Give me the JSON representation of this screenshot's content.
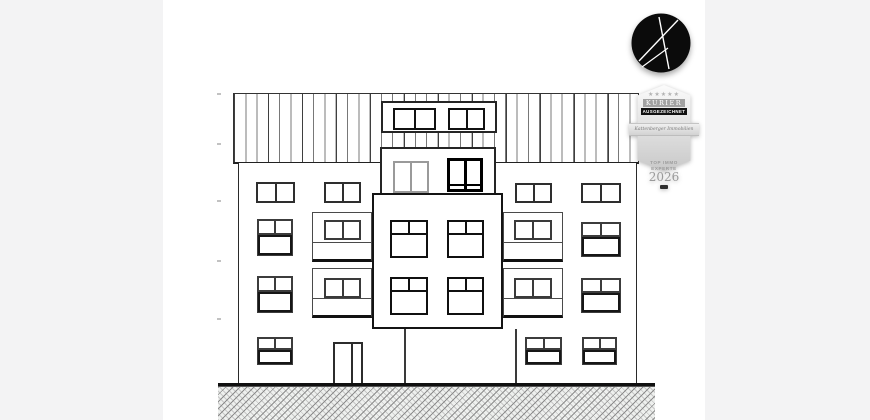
{
  "page": {
    "bg_color": "#f3f3f4",
    "canvas_bg": "#ffffff"
  },
  "branding": {
    "logo": {
      "shape": "black-circle-with-stylized-white-K",
      "bg": "#0b0b0b",
      "stroke": "#ffffff"
    },
    "badge": {
      "stars_text": "★★★★★",
      "masthead": "KURIER",
      "award": "AUSGEZEICHNET",
      "ribbon": "Kattenberger Immobilien",
      "category_line1": "TOP IMMO",
      "category_line2": "EXPERTE",
      "year": "2026"
    }
  },
  "drawing": {
    "kind": "building front elevation, line drawing",
    "line_color": "#2a2a2a",
    "roof": {
      "x": 233,
      "y": 93,
      "w": 406,
      "h": 71
    },
    "facade": {
      "x": 238,
      "y": 163,
      "w": 399,
      "h": 221
    },
    "dormer": {
      "x": 381,
      "y": 101,
      "w": 116,
      "h": 32
    },
    "penthouse": {
      "x": 380,
      "y": 147,
      "w": 116,
      "h": 48
    },
    "bay": {
      "x": 372,
      "y": 193,
      "w": 131,
      "h": 136
    },
    "bay_base_walls": [
      {
        "x": 404,
        "y": 329,
        "h": 55
      },
      {
        "x": 515,
        "y": 329,
        "h": 55
      }
    ],
    "door": {
      "x": 333,
      "y": 342,
      "w": 30,
      "h": 42
    },
    "ground_line": {
      "x": 218,
      "y": 383,
      "w": 437,
      "h": 2.5
    },
    "ground_hatch": {
      "x": 218,
      "y": 385.5,
      "w": 437,
      "h": 34.5
    },
    "level_ticks": [
      {
        "x": 217,
        "y": 93
      },
      {
        "x": 217,
        "y": 143
      },
      {
        "x": 217,
        "y": 200
      },
      {
        "x": 217,
        "y": 260
      },
      {
        "x": 217,
        "y": 318
      }
    ],
    "balconies": [
      {
        "x": 312,
        "y": 212,
        "w": 60,
        "h": 50,
        "railing_h": 20
      },
      {
        "x": 503,
        "y": 212,
        "w": 60,
        "h": 50,
        "railing_h": 20
      },
      {
        "x": 312,
        "y": 268,
        "w": 60,
        "h": 50,
        "railing_h": 20
      },
      {
        "x": 503,
        "y": 268,
        "w": 60,
        "h": 50,
        "railing_h": 20
      }
    ],
    "windows": [
      {
        "x": 393,
        "y": 108,
        "w": 43,
        "h": 22,
        "style": "bold2"
      },
      {
        "x": 448,
        "y": 108,
        "w": 37,
        "h": 22,
        "style": "bold2"
      },
      {
        "x": 393,
        "y": 161,
        "w": 36,
        "h": 32,
        "style": "light2"
      },
      {
        "x": 447,
        "y": 158,
        "w": 36,
        "h": 34,
        "style": "heavy2"
      },
      {
        "x": 256,
        "y": 182,
        "w": 39,
        "h": 21,
        "style": "pane2"
      },
      {
        "x": 324,
        "y": 182,
        "w": 37,
        "h": 21,
        "style": "pane2"
      },
      {
        "x": 515,
        "y": 183,
        "w": 37,
        "h": 20,
        "style": "pane2"
      },
      {
        "x": 581,
        "y": 183,
        "w": 40,
        "h": 20,
        "style": "pane2"
      },
      {
        "x": 257,
        "y": 219,
        "w": 36,
        "h": 37,
        "style": "tee"
      },
      {
        "x": 581,
        "y": 222,
        "w": 40,
        "h": 35,
        "style": "tee"
      },
      {
        "x": 257,
        "y": 276,
        "w": 36,
        "h": 37,
        "style": "tee"
      },
      {
        "x": 581,
        "y": 278,
        "w": 40,
        "h": 35,
        "style": "tee"
      },
      {
        "x": 257,
        "y": 337,
        "w": 36,
        "h": 28,
        "style": "tee"
      },
      {
        "x": 525,
        "y": 337,
        "w": 37,
        "h": 28,
        "style": "tee"
      },
      {
        "x": 582,
        "y": 337,
        "w": 35,
        "h": 28,
        "style": "tee"
      },
      {
        "x": 390,
        "y": 220,
        "w": 38,
        "h": 38,
        "style": "bayT"
      },
      {
        "x": 447,
        "y": 220,
        "w": 37,
        "h": 38,
        "style": "bayT"
      },
      {
        "x": 390,
        "y": 277,
        "w": 38,
        "h": 38,
        "style": "bayT"
      },
      {
        "x": 447,
        "y": 277,
        "w": 37,
        "h": 38,
        "style": "bayT"
      },
      {
        "x": 324,
        "y": 220,
        "w": 37,
        "h": 20,
        "style": "balc"
      },
      {
        "x": 514,
        "y": 220,
        "w": 38,
        "h": 20,
        "style": "balc"
      },
      {
        "x": 324,
        "y": 278,
        "w": 37,
        "h": 20,
        "style": "balc"
      },
      {
        "x": 514,
        "y": 278,
        "w": 38,
        "h": 20,
        "style": "balc"
      }
    ]
  }
}
